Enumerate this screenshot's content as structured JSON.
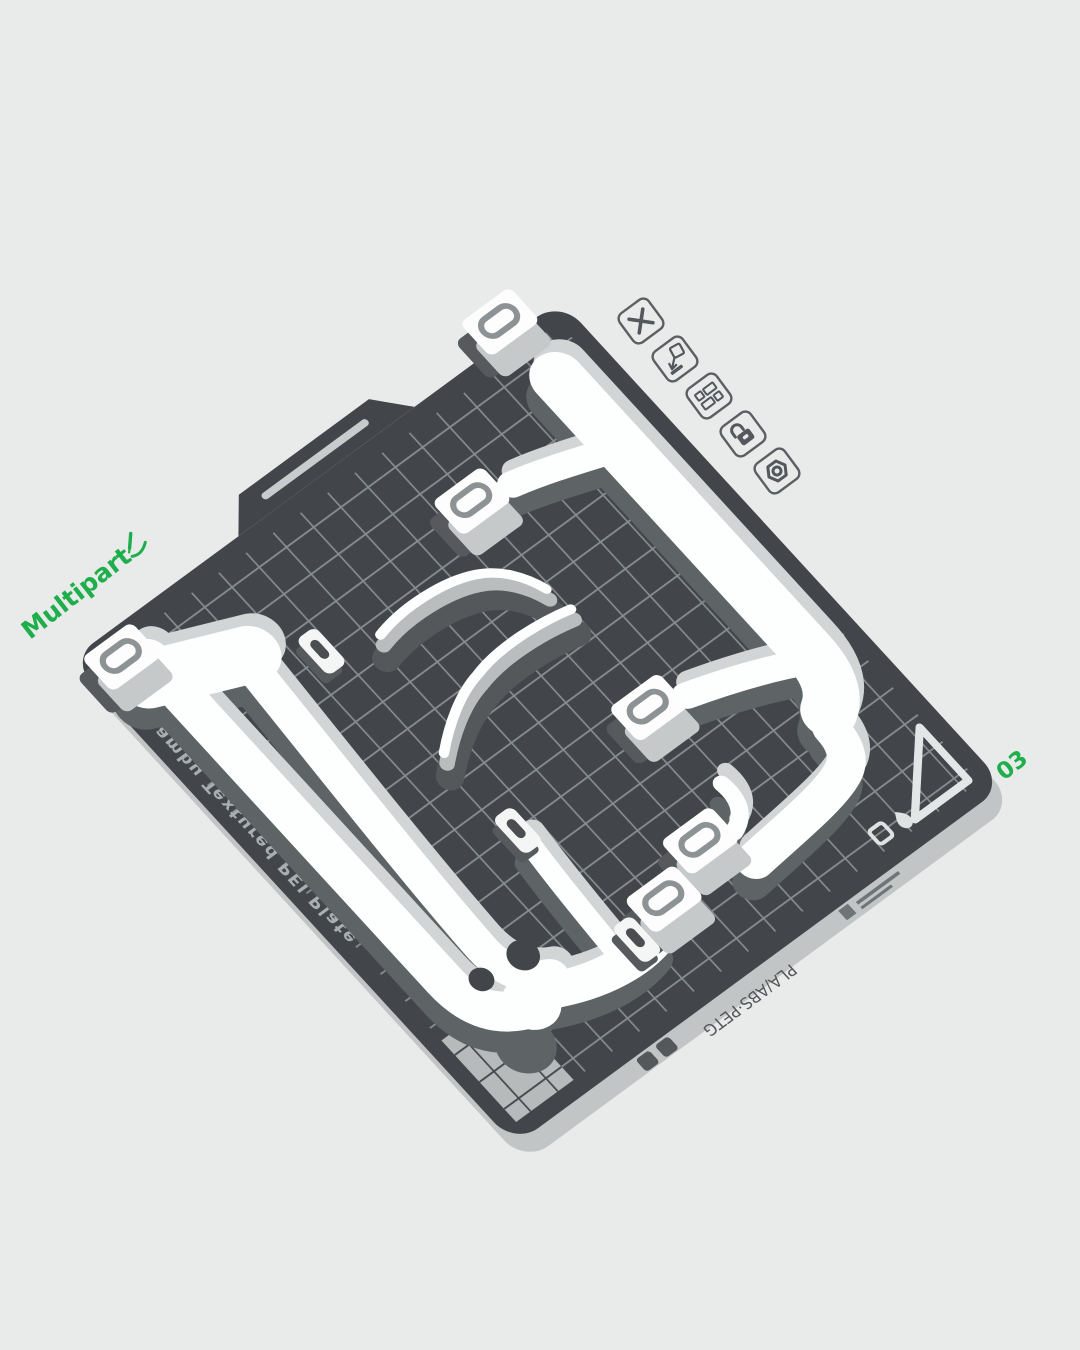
{
  "viewport": {
    "background_color": "#e9eaea"
  },
  "plate": {
    "name": "Multipart",
    "number": "03",
    "edge_text": "Bambu Textured PEI Plate",
    "material_text": "PLA/ABS·PETG",
    "surface_color": "#42464a",
    "grid_color": "#8f9496",
    "accent_color": "#1fae4c"
  },
  "plate_toolbar": {
    "buttons": [
      {
        "name": "delete-plate",
        "icon": "x-icon"
      },
      {
        "name": "arrange-plate",
        "icon": "arrow-into-plate-icon"
      },
      {
        "name": "plate-layout",
        "icon": "layout-grid-icon"
      },
      {
        "name": "lock-plate",
        "icon": "padlock-icon"
      },
      {
        "name": "plate-settings",
        "icon": "hex-nut-icon"
      }
    ]
  },
  "model": {
    "color": "#ffffff",
    "parts": [
      "frame-rails",
      "corner-gussets",
      "curved-blades",
      "slot-tabs"
    ]
  }
}
